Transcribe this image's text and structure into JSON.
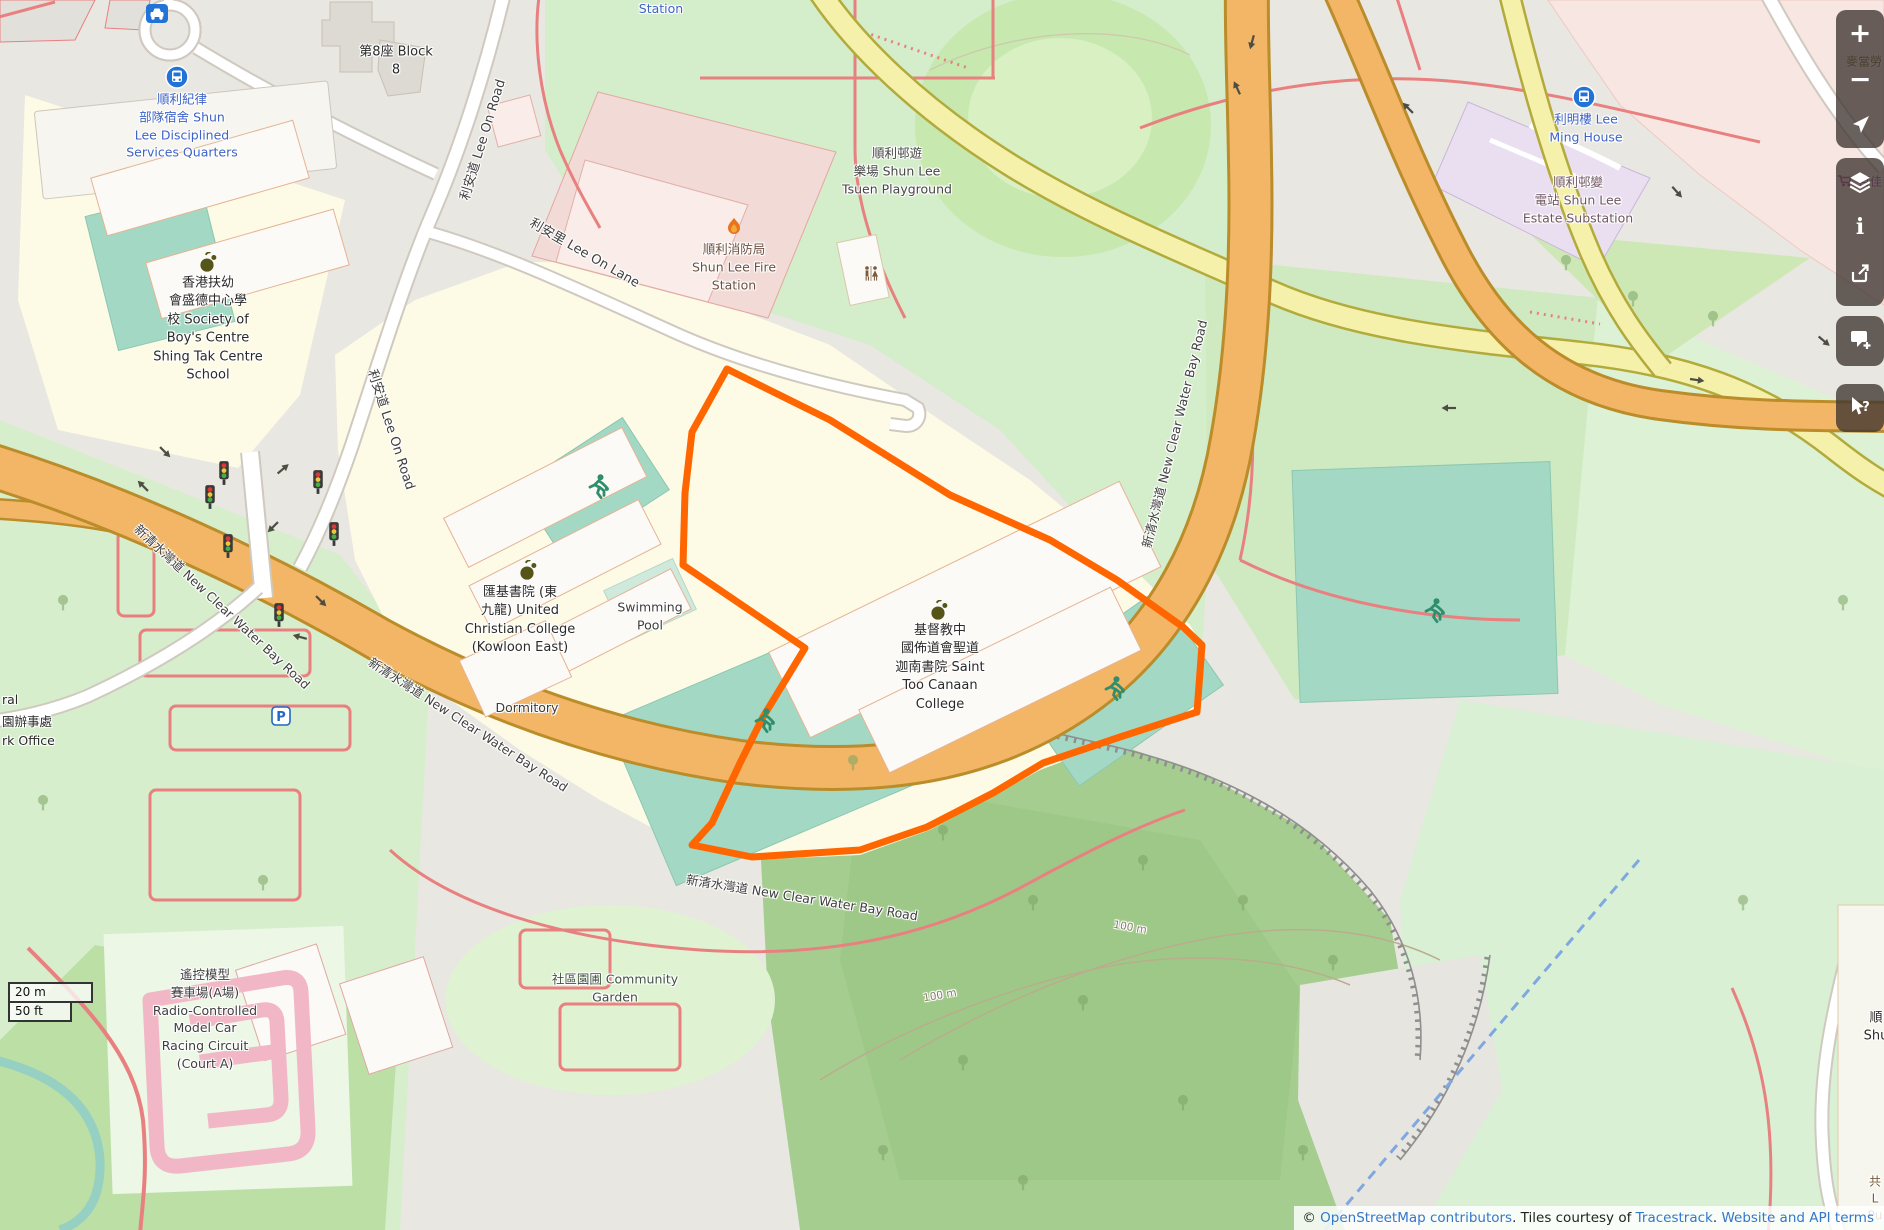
{
  "app": {
    "name": "OpenStreetMap slippy map view"
  },
  "labels": [
    {
      "name": "station-partial",
      "text": "Station"
    },
    {
      "name": "shun-lee-disciplined-services-quarters",
      "text": "順利紀律\n部隊宿舍 Shun\nLee Disciplined\nServices Quarters"
    },
    {
      "name": "block-8",
      "text": "第8座 Block\n8"
    },
    {
      "name": "shun-lee-tsuen-playground",
      "text": "順利邨遊\n樂場 Shun Lee\nTsuen Playground"
    },
    {
      "name": "shun-lee-fire-station",
      "text": "順利消防局\nShun Lee Fire\nStation"
    },
    {
      "name": "lee-ming-house",
      "text": "利明樓 Lee\nMing House"
    },
    {
      "name": "shun-lee-estate-substation",
      "text": "順利邨變\n電站 Shun Lee\nEstate Substation"
    },
    {
      "name": "shing-tak-centre-school",
      "text": "香港扶幼\n會盛德中心學\n校 Society of\nBoy's Centre\nShing Tak Centre\nSchool"
    },
    {
      "name": "united-christian-college",
      "text": "匯基書院 (東\n九龍) United\nChristian College\n(Kowloon East)"
    },
    {
      "name": "swimming-pool",
      "text": "Swimming\nPool"
    },
    {
      "name": "dormitory",
      "text": "Dormitory"
    },
    {
      "name": "saint-too-canaan-college",
      "text": "基督教中\n國佈道會聖道\n迦南書院 Saint\nToo Canaan\nCollege"
    },
    {
      "name": "community-garden",
      "text": "社區園圃 Community\nGarden"
    },
    {
      "name": "model-car-racing-circuit",
      "text": "遙控模型\n賽車場(A場)\nRadio-Controlled\nModel Car\nRacing Circuit\n(Court A)"
    },
    {
      "name": "new-clear-water-bay-road-1",
      "text": "新清水灣道 New Clear Water Bay Road"
    },
    {
      "name": "new-clear-water-bay-road-2",
      "text": "新清水灣道 New Clear Water Bay Road"
    },
    {
      "name": "new-clear-water-bay-road-3",
      "text": "新清水灣道 New Clear Water Bay Road"
    },
    {
      "name": "new-clear-water-bay-road-4",
      "text": "新清水灣道 New Clear Water Bay Road"
    },
    {
      "name": "lee-on-road-upper",
      "text": "利安道 Lee On Road"
    },
    {
      "name": "lee-on-road-lower",
      "text": "利安道 Lee On Road"
    },
    {
      "name": "lee-on-lane",
      "text": "利安里 Lee On Lane"
    },
    {
      "name": "contour-100m-a",
      "text": "100 m"
    },
    {
      "name": "contour-100m-b",
      "text": "100 m"
    },
    {
      "name": "edge-partial-ral",
      "text": "ral"
    },
    {
      "name": "edge-partial-office-zh",
      "text": "園辦事處"
    },
    {
      "name": "edge-partial-office-en",
      "text": "rk Office"
    },
    {
      "name": "edge-partial-mcdonalds",
      "text": "麥當勞"
    },
    {
      "name": "edge-partial-parknshop",
      "text": "百佳"
    },
    {
      "name": "edge-partial-shun",
      "text": "順\nShu"
    },
    {
      "name": "edge-partial-br",
      "text": "共\nL\nPu"
    }
  ],
  "controls": {
    "zoom_in": "+",
    "zoom_out": "−",
    "info_glyph": "i",
    "query_glyph": "?",
    "icon_names": [
      "zoom-in",
      "zoom-out",
      "locate",
      "layers",
      "info",
      "share",
      "add-note",
      "query-features"
    ]
  },
  "icons": {
    "parking_glyph": "P"
  },
  "scalebar": {
    "metric": "20 m",
    "imperial": "50 ft"
  },
  "attribution": {
    "copyright": "© ",
    "osm_link": "OpenStreetMap contributors",
    "middle": ". Tiles courtesy of ",
    "tracestrack_link": "Tracestrack",
    "sep": ". ",
    "terms_link": "Website and API terms"
  },
  "colors": {
    "highlight": "#ff6600",
    "road_primary": "#f2b666",
    "road_secondary": "#f5f1ab",
    "pitch": "#a3d9c4",
    "forest": "#a6cd90",
    "park": "#d6eecb",
    "school_area": "#fdfbe6",
    "fire_station_area": "#f2dbd7",
    "poi_blue": "#3d63c8",
    "control_bg": "rgba(62,53,48,0.78)"
  }
}
